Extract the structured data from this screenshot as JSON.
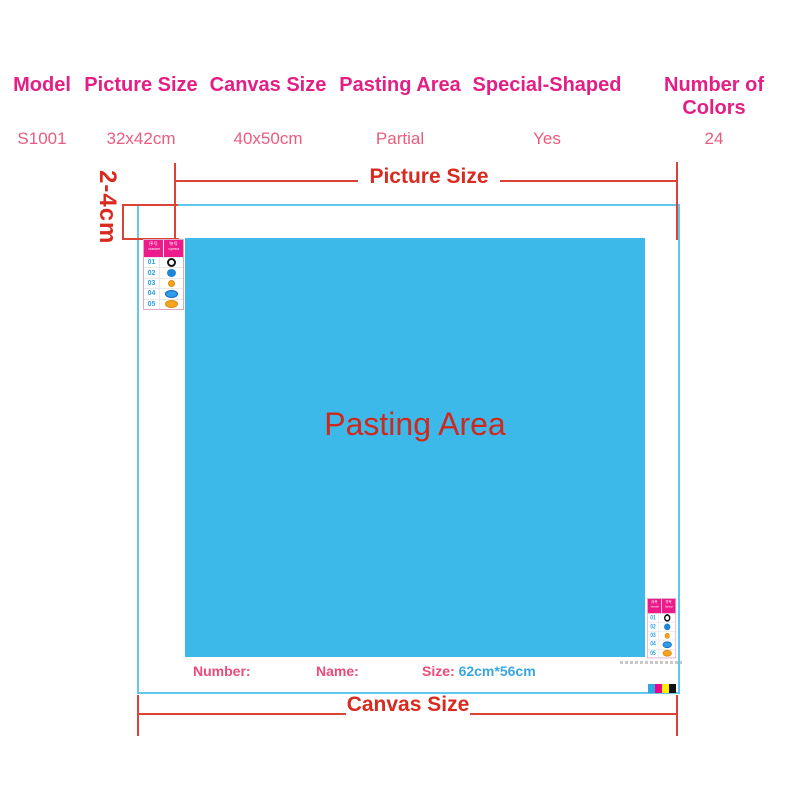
{
  "colors": {
    "header_pink": "#e31f86",
    "value_pink": "#e85c80",
    "diagram_red": "#d92a1f",
    "canvas_border_blue": "#63c6ee",
    "pasting_fill_blue": "#3db9e9",
    "size_value_blue": "#3aa6e0",
    "legend_header_magenta": "#ec1a8b"
  },
  "spec_table": {
    "columns": [
      {
        "header": "Model",
        "value": "S1001"
      },
      {
        "header": "Picture Size",
        "value": "32x42cm"
      },
      {
        "header": "Canvas Size",
        "value": "40x50cm"
      },
      {
        "header": "Pasting Area",
        "value": "Partial"
      },
      {
        "header": "Special-Shaped",
        "value": "Yes"
      },
      {
        "header": "Number of Colors",
        "value": "24"
      }
    ]
  },
  "diagram": {
    "picture_size_label": "Picture Size",
    "canvas_size_label": "Canvas Size",
    "pasting_area_label": "Pasting Area",
    "margin_label": "2-4cm",
    "footer": {
      "number_label": "Number:",
      "name_label": "Name:",
      "size_label": "Size:",
      "size_value": "62cm*56cm"
    },
    "legend": {
      "header": [
        {
          "top": "序号",
          "bottom": "Number"
        },
        {
          "top": "符号",
          "bottom": "Symbol"
        }
      ],
      "rows": [
        {
          "num": "01",
          "symbol": "black-ring"
        },
        {
          "num": "02",
          "symbol": "blue-dot"
        },
        {
          "num": "03",
          "symbol": "orange-dot"
        },
        {
          "num": "04",
          "symbol": "blue-oval"
        },
        {
          "num": "05",
          "symbol": "orange-oval"
        }
      ]
    },
    "print_marks": {
      "colors": [
        "#29abe2",
        "#ec008c",
        "#ffee00",
        "#111111"
      ]
    }
  }
}
